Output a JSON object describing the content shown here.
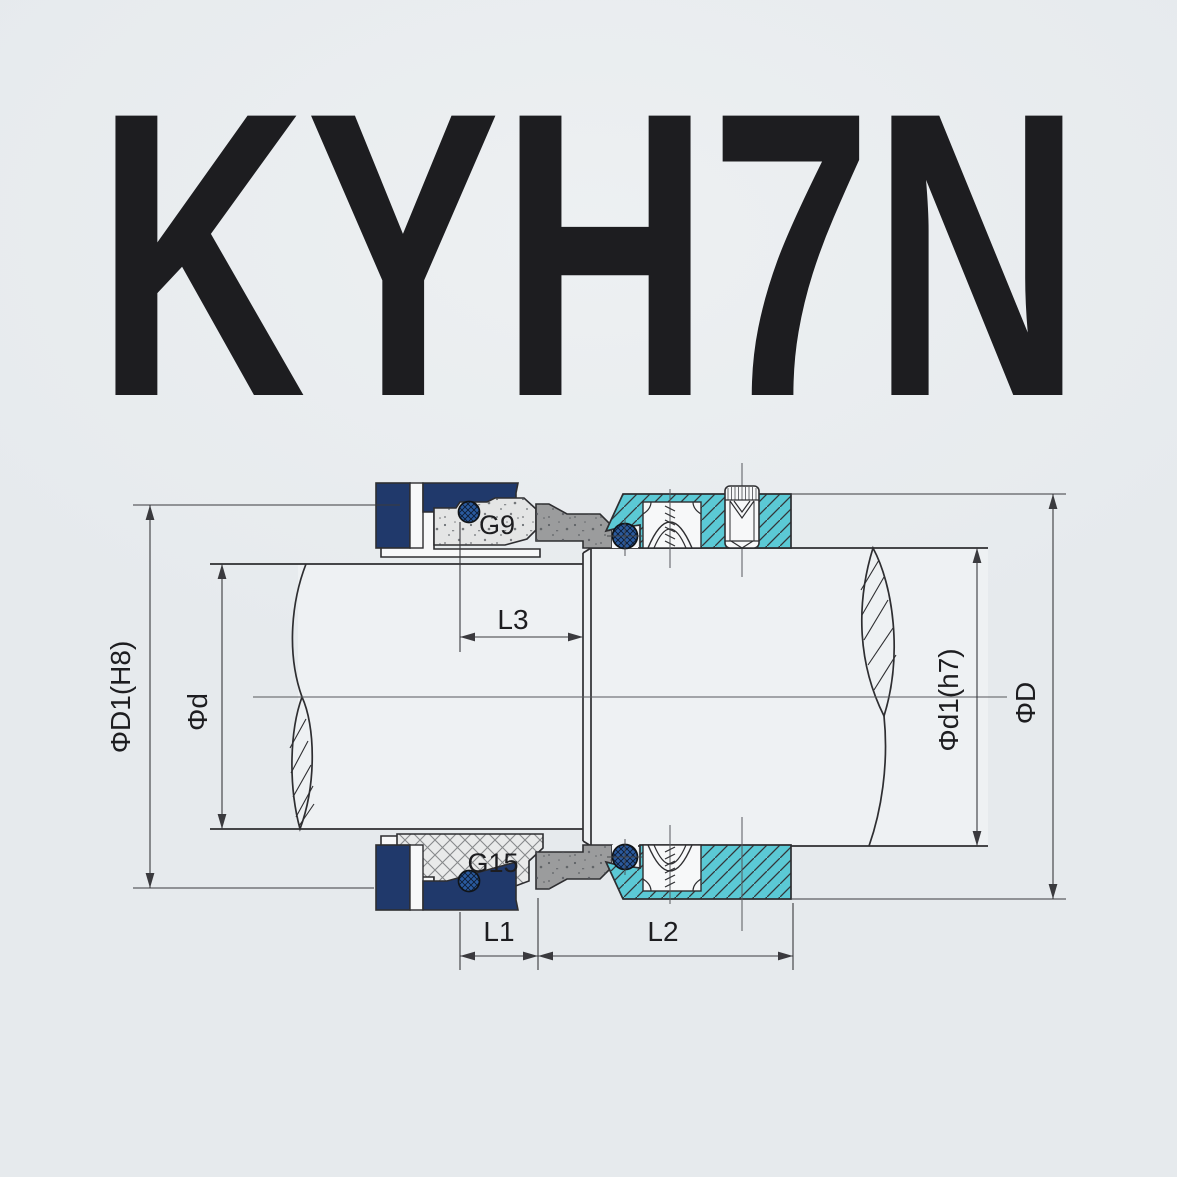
{
  "watermark": "KYH7N",
  "dimensions": {
    "d1_h8": "ΦD1(H8)",
    "d": "Φd",
    "d1_h7": "Φd1(h7)",
    "big_d": "ΦD",
    "l1": "L1",
    "l2": "L2",
    "l3": "L3"
  },
  "part_labels": {
    "g9": "G9",
    "g15": "G15"
  },
  "colors": {
    "background": "#e6eaed",
    "navy": "#20396b",
    "teal": "#5bc9d5",
    "oring_blue": "#2a5a9e",
    "collar_gray": "#9b9c9d",
    "face_gray": "#e4e5e5",
    "shaft_fill": "#eef1f3",
    "line": "#2e2e31",
    "dim_line": "#3a3a3e",
    "white_part": "#f7f8f9"
  }
}
